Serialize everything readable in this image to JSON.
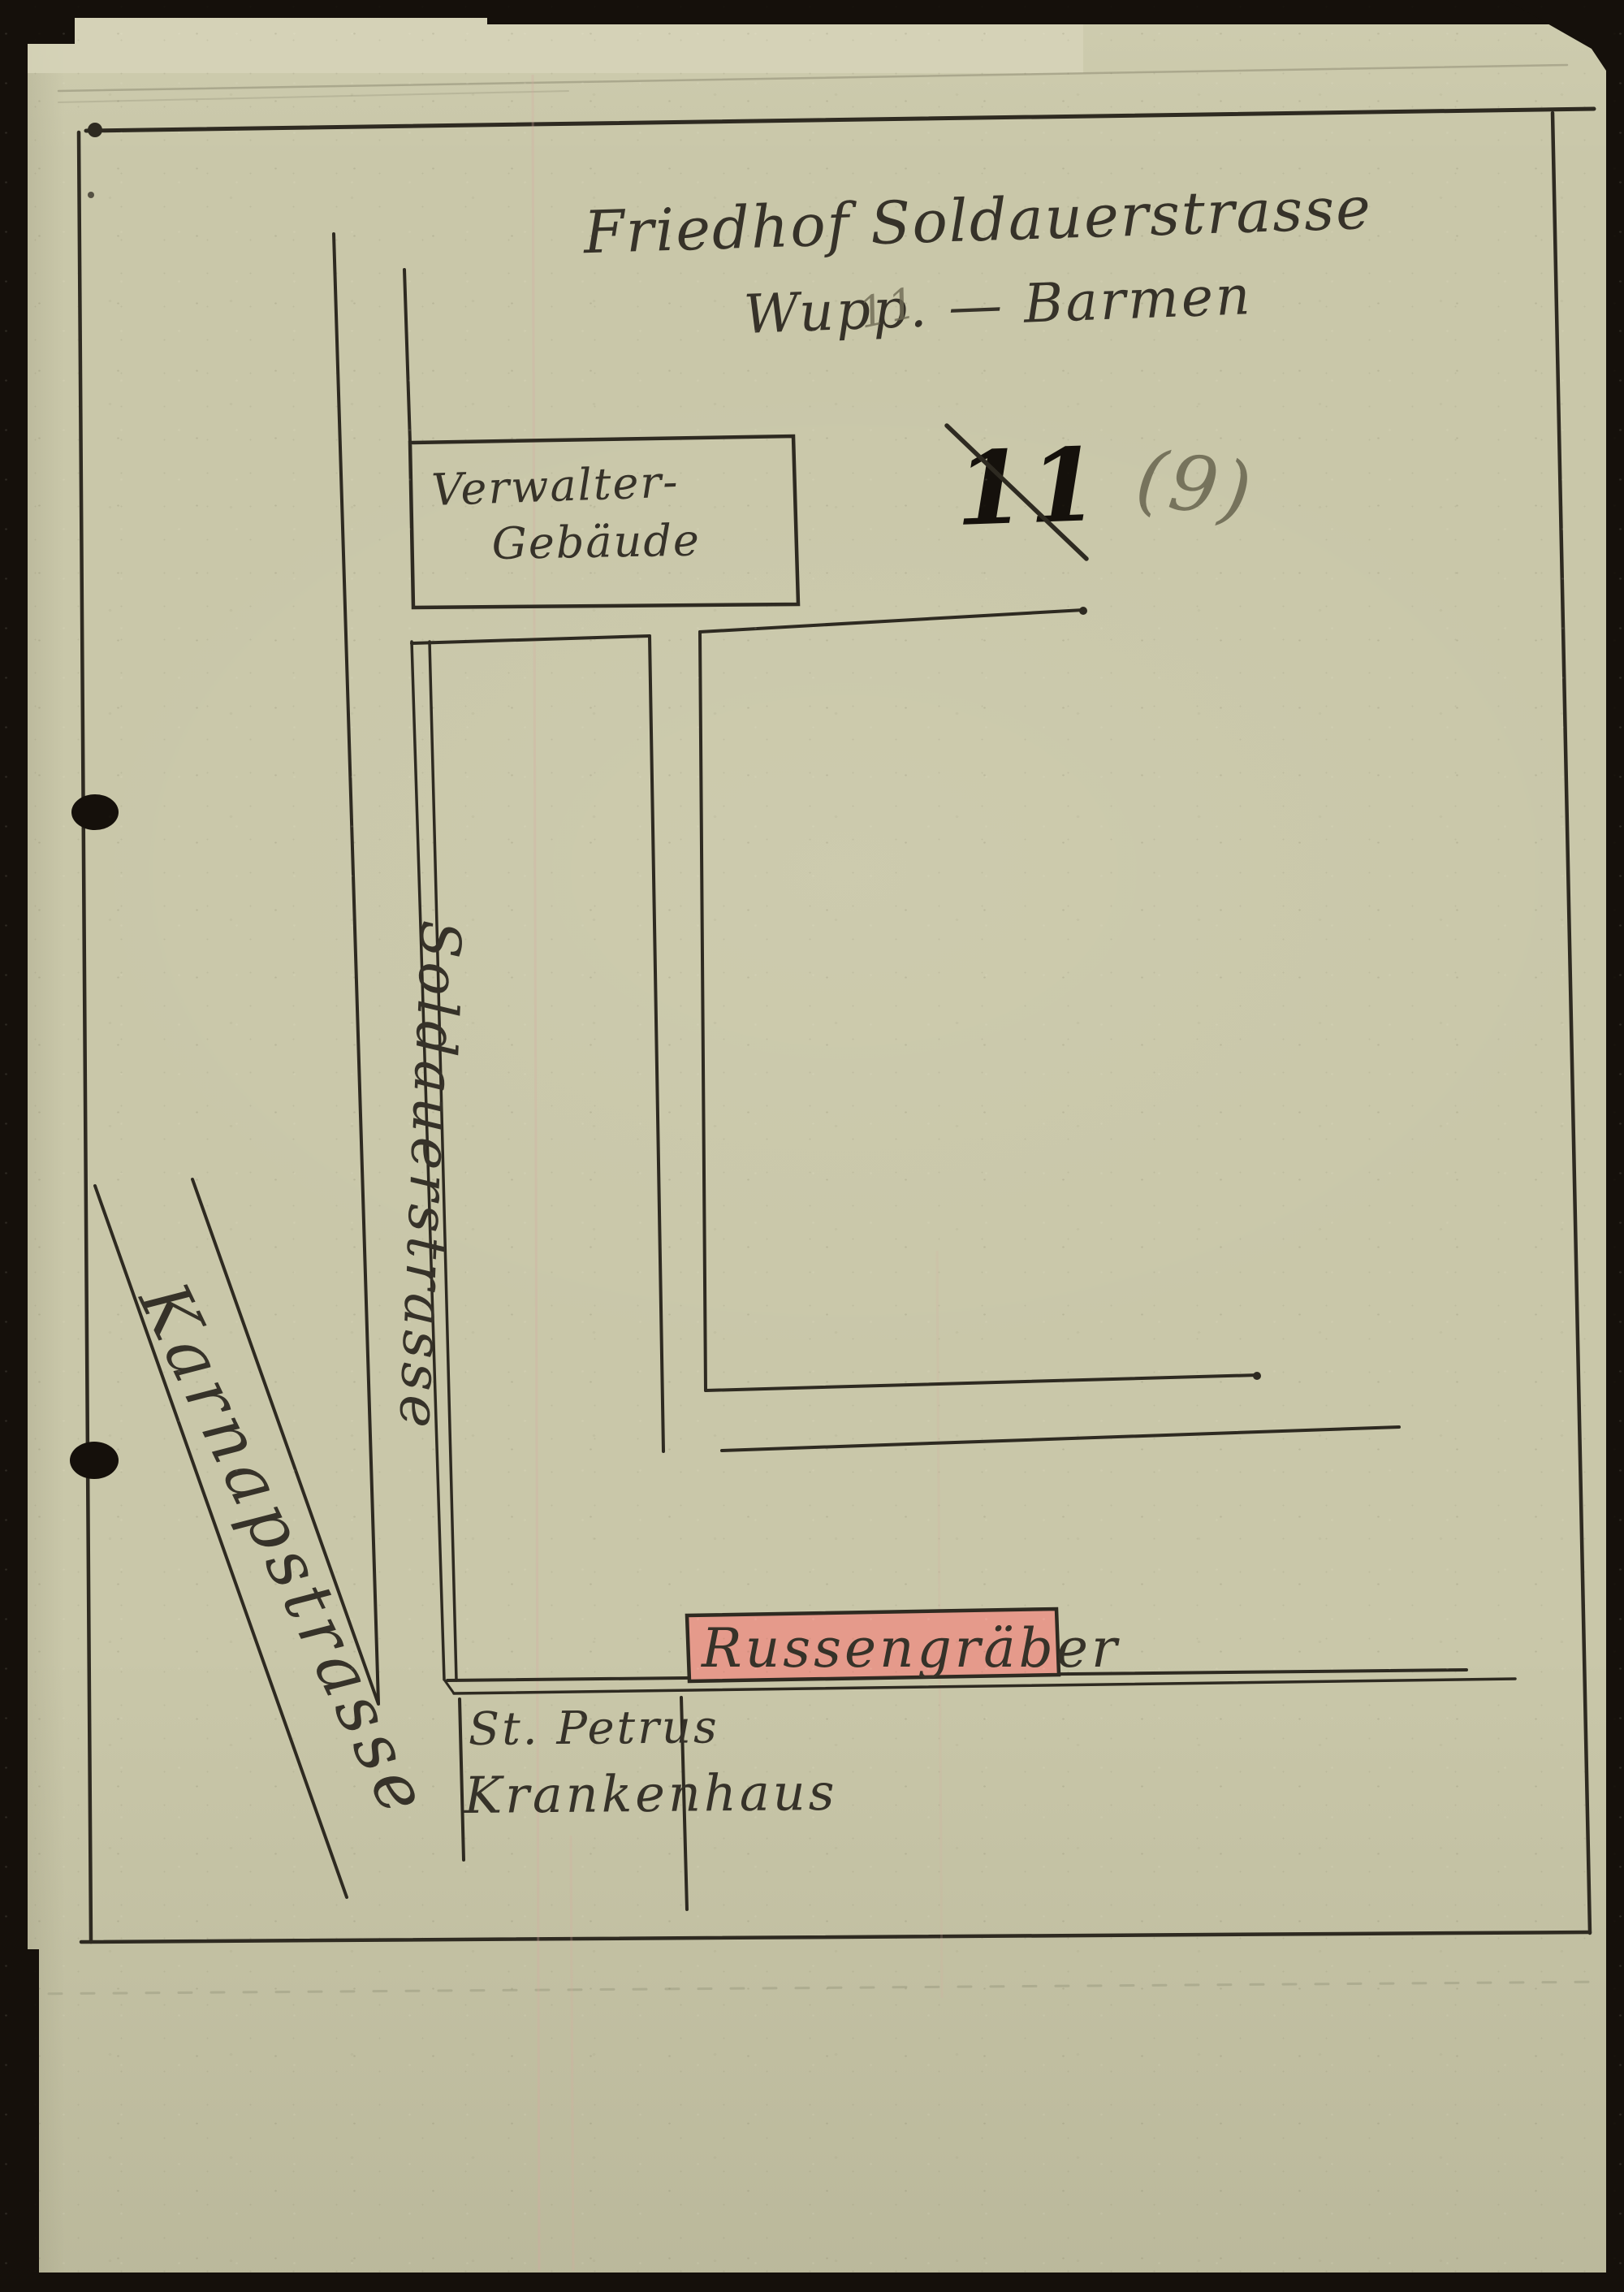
{
  "title": {
    "line1": "Friedhof Soldauerstrasse",
    "line2": "Wupp. — Barmen"
  },
  "markings": {
    "faint_number": "11",
    "crossed_number": "11",
    "pencil_number": "(9)"
  },
  "map_labels": {
    "admin_building_line1": "Verwalter-",
    "admin_building_line2": "Gebäude",
    "street_soldauerstrasse": "Soldauerstrasse",
    "street_karnapstrasse": "Karnapstrasse",
    "russian_graves": "Russengräber",
    "hospital_line1": "St. Petrus",
    "hospital_line2": "Krankenhaus"
  },
  "colors": {
    "paper": "#c9c7a9",
    "paper_edge": "#d6d4b9",
    "ink": "#2e2a21",
    "ink_text": "#363229",
    "ink_heavy": "#15110c",
    "pencil": "#6e6a54",
    "pencil_faint": "#908c75",
    "highlight": "#e59a8b",
    "scan_black": "#15100b",
    "crease": "#a8a78c",
    "fold_pink": "#d9aaa0"
  }
}
